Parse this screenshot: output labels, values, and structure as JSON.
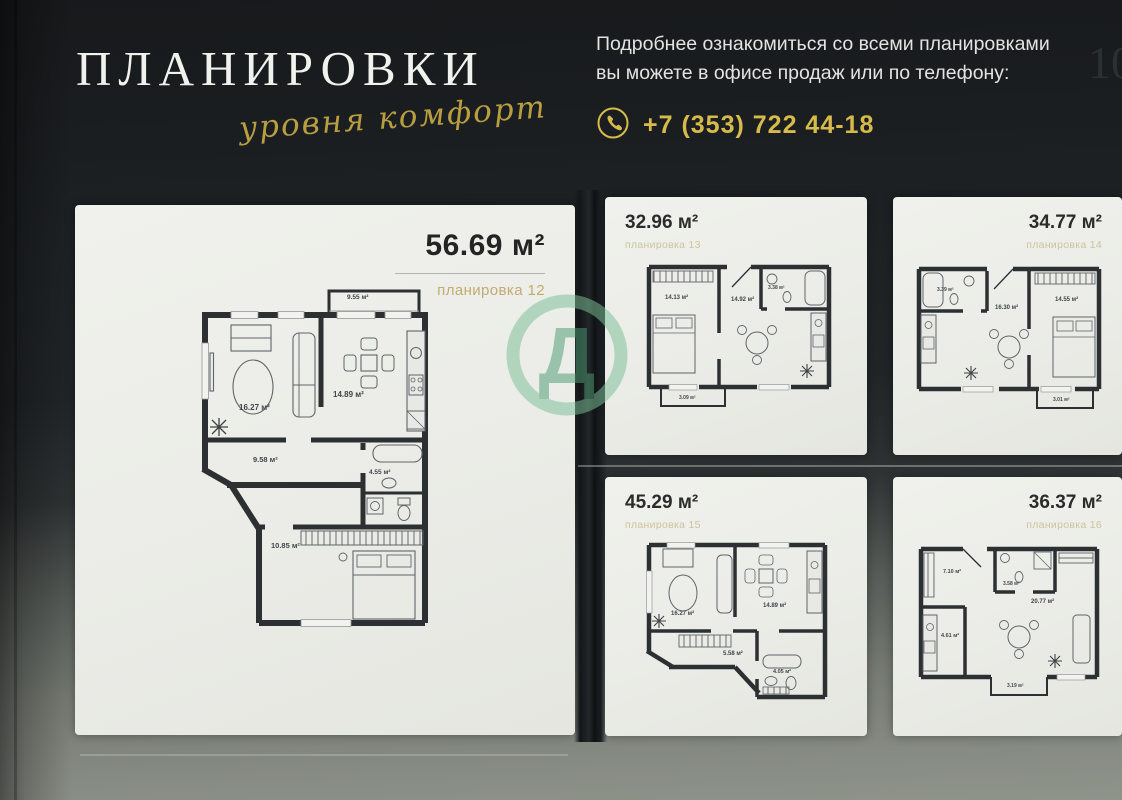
{
  "header": {
    "title": "ПЛАНИРОВКИ",
    "tagline": "уровня комфорт",
    "info_line1": "Подробнее ознакомиться со всеми планировками",
    "info_line2": "вы можете в офисе продаж или по телефону:",
    "phone": "+7 (353) 722 44-18",
    "page_number": "10"
  },
  "watermark": {
    "letter": "Д",
    "ring_color": "#7cbf97",
    "letter_color": "#4d9b72"
  },
  "featured_plan": {
    "area": "56.69 м²",
    "label": "планировка 12",
    "rooms": {
      "living": "16.27 м²",
      "kitchen": "14.89 м²",
      "hall": "9.58 м²",
      "bath": "4.55 м²",
      "bedroom": "10.85 м²",
      "balcony": "9.55 м²"
    }
  },
  "plan_cards": [
    {
      "area": "32.96 м²",
      "label": "планировка 13",
      "rooms": {
        "bedroom": "14.13 м²",
        "living": "14.92 м²",
        "bath": "3.38 м²",
        "balcony": "3.09 м²"
      }
    },
    {
      "area": "34.77 м²",
      "label": "планировка 14",
      "rooms": {
        "bath": "3.39 м²",
        "living": "16.30 м²",
        "bedroom": "14.55 м²",
        "balcony": "3.01 м²"
      }
    },
    {
      "area": "45.29 м²",
      "label": "планировка 15",
      "rooms": {
        "living": "16.27 м²",
        "kitchen": "14.89 м²",
        "hall": "5.58 м²",
        "bath": "4.05 м²"
      }
    },
    {
      "area": "36.37 м²",
      "label": "планировка 16",
      "rooms": {
        "hall": "7.10 м²",
        "bath": "3.58 м²",
        "living": "20.77 м²",
        "kitchen": "4.61 м²",
        "balcony": "3.19 м²"
      }
    }
  ],
  "colors": {
    "gold": "#d6ba4a",
    "plan_name_gold": "#c2ab70",
    "card_bg": "#edeee9",
    "wall": "#2d3032"
  }
}
